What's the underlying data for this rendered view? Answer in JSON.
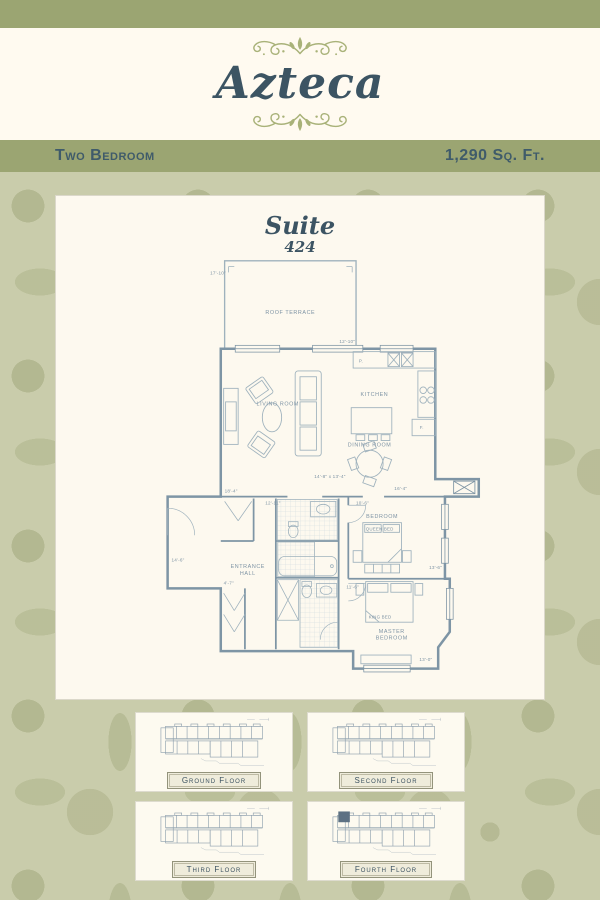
{
  "header": {
    "title": "Azteca"
  },
  "band": {
    "left": "Two Bedroom",
    "right": "1,290 Sq. Ft."
  },
  "suite": {
    "label": "Suite",
    "number": "424"
  },
  "plan": {
    "rooms": {
      "roof_terrace": "ROOF TERRACE",
      "living_room": "LIVING ROOM",
      "kitchen": "KITCHEN",
      "dining_room": "DINING ROOM",
      "entrance_hall_line1": "ENTRANCE",
      "entrance_hall_line2": "HALL",
      "bedroom": "BEDROOM",
      "queen_bed": "QUEEN BED",
      "master_bedroom_line1": "MASTER",
      "master_bedroom_line2": "BEDROOM",
      "king_bed": "KING BED",
      "pantry": "P.",
      "fridge": "F."
    },
    "dims": {
      "terrace_width": "17'-10\"",
      "terrace_depth": "12'-10\"",
      "living_dining": "14'-8\" x 13'-4\"",
      "living_side": "18'-4\"",
      "corridor": "12'-11\"",
      "shaft_side": "16'-4\"",
      "bedroom_width": "10'-6\"",
      "bedroom_depth": "13'-6\"",
      "hall_side": "14'-6\"",
      "hall_width": "4'-7\"",
      "master_width": "11'-6\"",
      "master_depth": "13'-0\""
    }
  },
  "keyplans": [
    {
      "label": "Ground Floor",
      "highlighted": false
    },
    {
      "label": "Second Floor",
      "highlighted": false
    },
    {
      "label": "Third Floor",
      "highlighted": false
    },
    {
      "label": "Fourth Floor",
      "highlighted": true
    }
  ],
  "colors": {
    "olive_band": "#9ba572",
    "cream": "#fffaf0",
    "title_ink": "#3c5463",
    "ornament": "#a9b279",
    "pattern_base": "#c9ccab",
    "pattern_motif": "#b4b88f",
    "plan_ink": "#7d93a4",
    "wall_ink": "#7e95a5",
    "highlight": "#5d7183"
  }
}
